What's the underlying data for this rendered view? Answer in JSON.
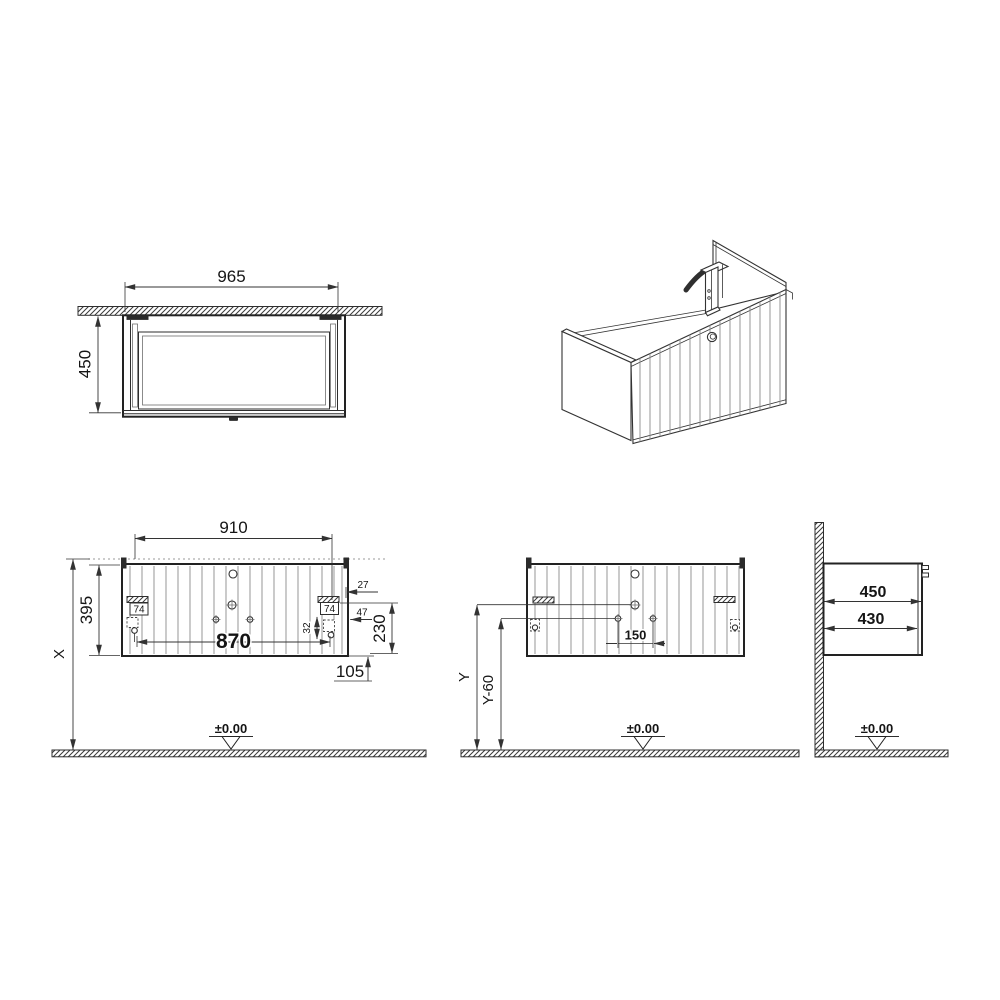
{
  "colors": {
    "line": "#2e2e2e",
    "text": "#151515",
    "background": "#ffffff"
  },
  "views": {
    "top": {
      "width": "965",
      "depth": "450"
    },
    "front": {
      "rail_span": "910",
      "body_height": "395",
      "inner_span": "870",
      "floor_distance": "X",
      "edge_offset": "27",
      "bracket_left": "74",
      "bracket_right": "74",
      "slide_offset": "47",
      "slide_gap": "32",
      "slide_height": "230",
      "bottom_offset": "105",
      "datum": "±0.00"
    },
    "install": {
      "hole_spacing": "150",
      "height_y": "Y",
      "height_y60": "Y-60",
      "datum": "±0.00"
    },
    "side": {
      "depth_outer": "450",
      "depth_inner": "430",
      "datum": "±0.00"
    }
  }
}
